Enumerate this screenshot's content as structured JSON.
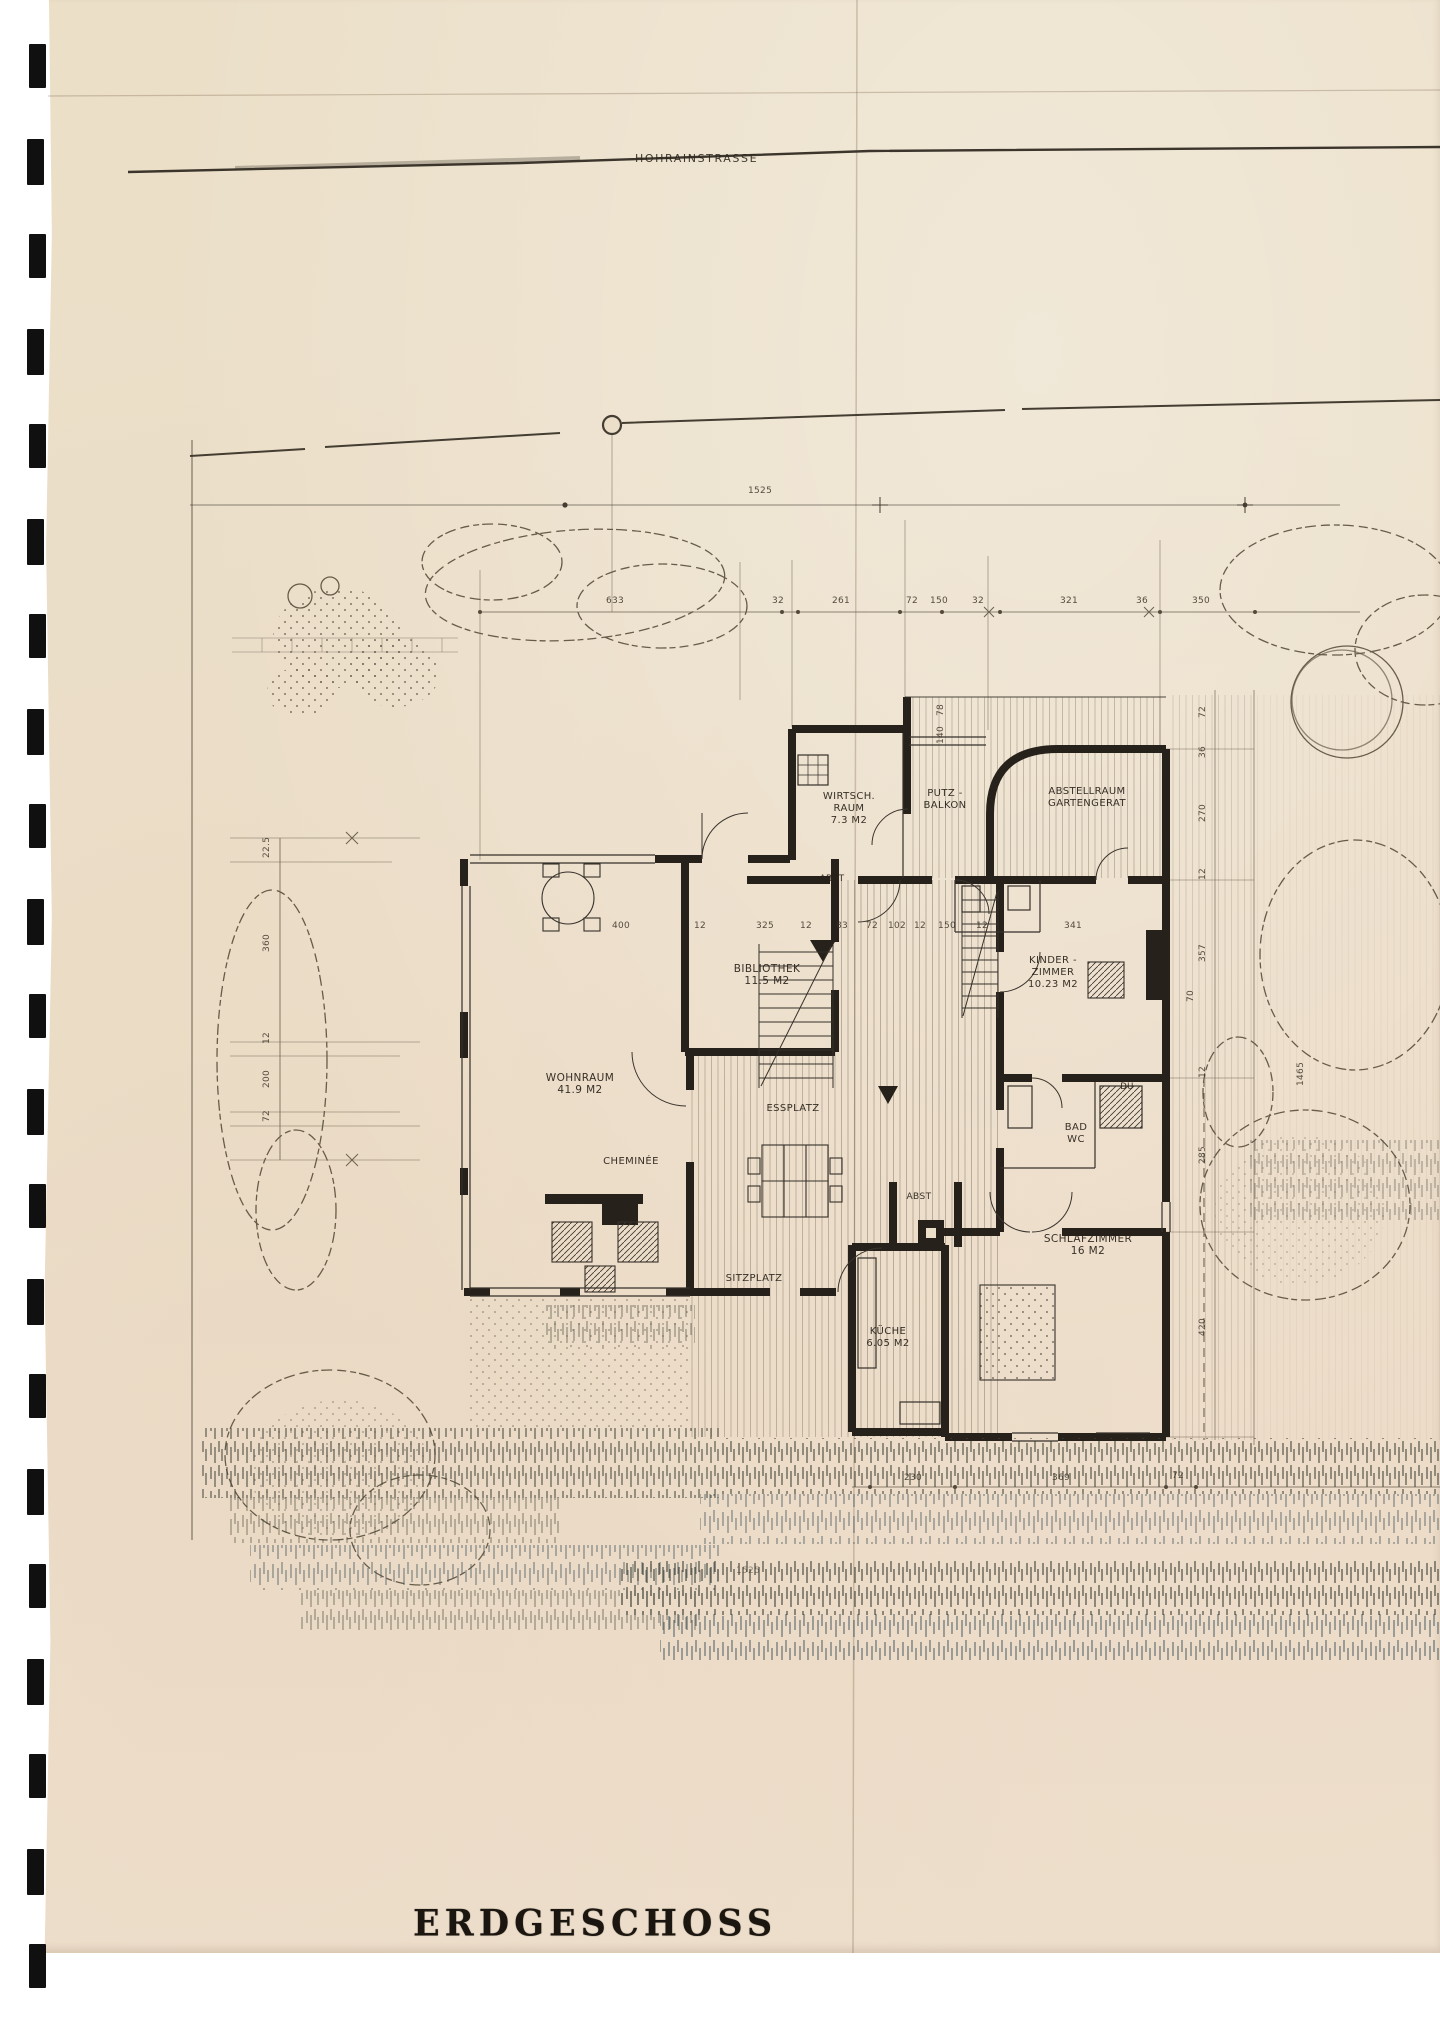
{
  "page": {
    "street_label": "HOHRAINSTRASSE",
    "title": "ERDGESCHOSS"
  },
  "binding_marks_count": 21,
  "colors": {
    "paper": "#ecdfca",
    "ink": "#26211a",
    "thin_line": "#3f3931",
    "construction_line": "#77694f",
    "grass_dark": "#43463b",
    "grass_blue": "#4e5d64"
  },
  "rooms": [
    {
      "id": "wirtschaftsraum",
      "label": "WIRTSCH. RAUM",
      "sublabel": "7.3 M2",
      "x": 818,
      "y": 791,
      "w": 62,
      "size": 10
    },
    {
      "id": "putz-balkon",
      "label": "PUTZ - BALKON",
      "sublabel": "",
      "x": 916,
      "y": 788,
      "w": 58,
      "size": 10
    },
    {
      "id": "abstellraum-gartengeraet",
      "label": "ABSTELLRAUM",
      "sublabel": "GARTENGERAT",
      "x": 1022,
      "y": 786,
      "w": 130,
      "size": 10
    },
    {
      "id": "abstellkammer-nord",
      "label": "ABST",
      "sublabel": "",
      "x": 812,
      "y": 874,
      "w": 40,
      "size": 9
    },
    {
      "id": "wc",
      "label": "WC",
      "sublabel": "",
      "x": 990,
      "y": 877,
      "w": 30,
      "size": 9
    },
    {
      "id": "bibliothek",
      "label": "BIBLIOTHEK",
      "sublabel": "11.5 M2",
      "x": 722,
      "y": 963,
      "w": 90,
      "size": 10.5
    },
    {
      "id": "kinderzimmer",
      "label": "KINDER - ZIMMER",
      "sublabel": "10.23 M2",
      "x": 1020,
      "y": 955,
      "w": 66,
      "size": 10
    },
    {
      "id": "wohnraum",
      "label": "WOHNRAUM",
      "sublabel": "41.9 M2",
      "x": 530,
      "y": 1072,
      "w": 100,
      "size": 10.5
    },
    {
      "id": "essplatz",
      "label": "ESSPLATZ",
      "sublabel": "",
      "x": 748,
      "y": 1103,
      "w": 90,
      "size": 10
    },
    {
      "id": "cheminee",
      "label": "CHEMINÉE",
      "sublabel": "",
      "x": 586,
      "y": 1156,
      "w": 90,
      "size": 10
    },
    {
      "id": "dusche",
      "label": "DU",
      "sublabel": "",
      "x": 1114,
      "y": 1082,
      "w": 26,
      "size": 8.5
    },
    {
      "id": "bad-wc",
      "label": "BAD WC",
      "sublabel": "",
      "x": 1058,
      "y": 1122,
      "w": 36,
      "size": 10
    },
    {
      "id": "abstellkammer-sued",
      "label": "ABST",
      "sublabel": "",
      "x": 899,
      "y": 1192,
      "w": 40,
      "size": 9
    },
    {
      "id": "schlafzimmer",
      "label": "SCHLAFZIMMER",
      "sublabel": "16 M2",
      "x": 1028,
      "y": 1233,
      "w": 120,
      "size": 10.5
    },
    {
      "id": "sitzplatz",
      "label": "SITZPLATZ",
      "sublabel": "",
      "x": 714,
      "y": 1273,
      "w": 80,
      "size": 10
    },
    {
      "id": "kueche",
      "label": "KÜCHE",
      "sublabel": "6.05 M2",
      "x": 858,
      "y": 1326,
      "w": 60,
      "size": 10
    }
  ],
  "dims": [
    {
      "t": "1525",
      "x": 748,
      "y": 486
    },
    {
      "t": "633",
      "x": 606,
      "y": 596
    },
    {
      "t": "32",
      "x": 772,
      "y": 596
    },
    {
      "t": "261",
      "x": 832,
      "y": 596
    },
    {
      "t": "72",
      "x": 906,
      "y": 596
    },
    {
      "t": "150",
      "x": 930,
      "y": 596
    },
    {
      "t": "32",
      "x": 972,
      "y": 596
    },
    {
      "t": "321",
      "x": 1060,
      "y": 596
    },
    {
      "t": "36",
      "x": 1136,
      "y": 596
    },
    {
      "t": "350",
      "x": 1192,
      "y": 596
    },
    {
      "t": "400",
      "x": 612,
      "y": 921
    },
    {
      "t": "12",
      "x": 694,
      "y": 921
    },
    {
      "t": "325",
      "x": 756,
      "y": 921
    },
    {
      "t": "12",
      "x": 800,
      "y": 921
    },
    {
      "t": "83",
      "x": 836,
      "y": 921
    },
    {
      "t": "72",
      "x": 866,
      "y": 921
    },
    {
      "t": "102",
      "x": 888,
      "y": 921
    },
    {
      "t": "12",
      "x": 914,
      "y": 921
    },
    {
      "t": "150",
      "x": 938,
      "y": 921
    },
    {
      "t": "12",
      "x": 976,
      "y": 921
    },
    {
      "t": "341",
      "x": 1064,
      "y": 921
    },
    {
      "t": "230",
      "x": 904,
      "y": 1473
    },
    {
      "t": "369",
      "x": 1052,
      "y": 1473
    },
    {
      "t": "72",
      "x": 1172,
      "y": 1471
    },
    {
      "t": "1525",
      "x": 736,
      "y": 1566,
      "o": 0.6
    },
    {
      "t": "22.5",
      "x": 262,
      "y": 858,
      "r": -90
    },
    {
      "t": "360",
      "x": 262,
      "y": 952,
      "r": -90
    },
    {
      "t": "12",
      "x": 262,
      "y": 1044,
      "r": -90
    },
    {
      "t": "200",
      "x": 262,
      "y": 1088,
      "r": -90
    },
    {
      "t": "72",
      "x": 262,
      "y": 1122,
      "r": -90
    },
    {
      "t": "72",
      "x": 1198,
      "y": 718,
      "r": -90
    },
    {
      "t": "36",
      "x": 1198,
      "y": 758,
      "r": -90
    },
    {
      "t": "270",
      "x": 1198,
      "y": 822,
      "r": -90
    },
    {
      "t": "12",
      "x": 1198,
      "y": 880,
      "r": -90
    },
    {
      "t": "357",
      "x": 1198,
      "y": 962,
      "r": -90
    },
    {
      "t": "12",
      "x": 1198,
      "y": 1078,
      "r": -90
    },
    {
      "t": "285",
      "x": 1198,
      "y": 1164,
      "r": -90
    },
    {
      "t": "420",
      "x": 1198,
      "y": 1336,
      "r": -90
    },
    {
      "t": "1465",
      "x": 1296,
      "y": 1086,
      "r": -90
    },
    {
      "t": "78",
      "x": 936,
      "y": 716,
      "r": -90
    },
    {
      "t": "140",
      "x": 936,
      "y": 744,
      "r": -90
    },
    {
      "t": "70",
      "x": 1186,
      "y": 1002,
      "r": -90
    }
  ]
}
